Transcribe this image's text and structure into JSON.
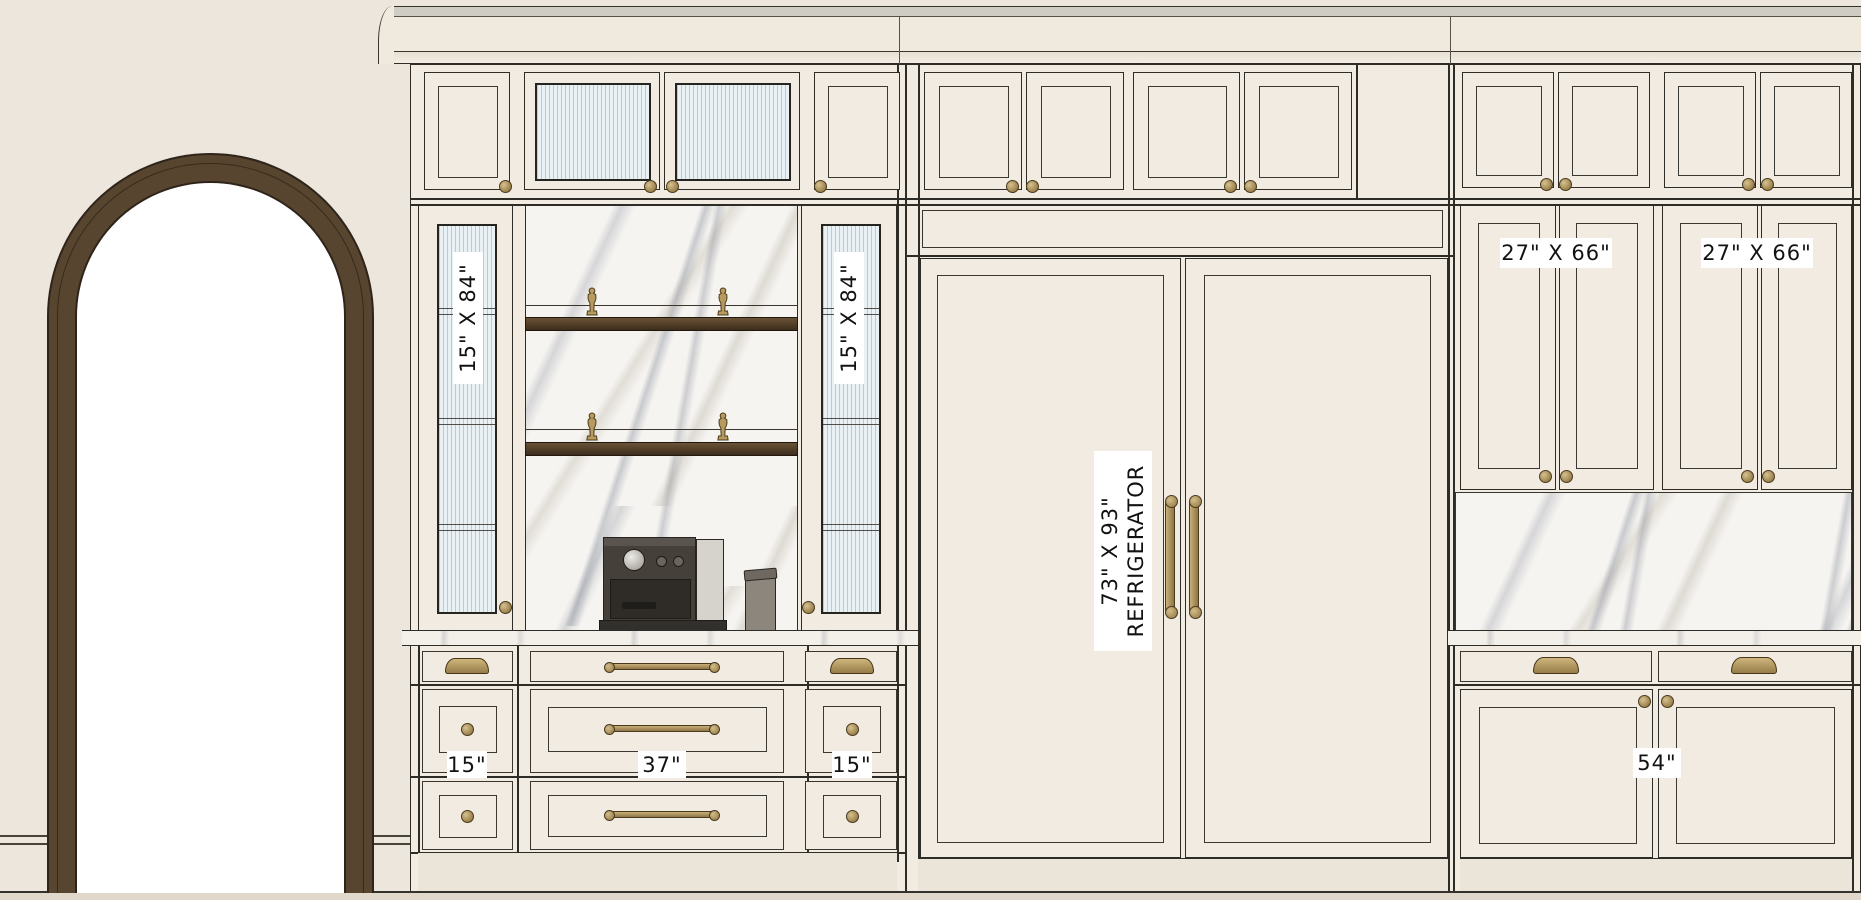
{
  "drawing": {
    "type": "kitchen-cabinetry-elevation",
    "labels": {
      "left_glass_left": "15\" X 84\"",
      "left_glass_right": "15\" X 84\"",
      "base_left": "15\"",
      "base_center": "37\"",
      "base_right": "15\"",
      "fridge_size": "73\" X 93\"",
      "fridge_name": "REFRIGERATOR",
      "right_upper_left": "27\" X 66\"",
      "right_upper_right": "27\" X 66\"",
      "right_base": "54\""
    },
    "colors": {
      "wall": "#ece6dc",
      "cabinet_face": "#f1ebe2",
      "outline": "#2e2c27",
      "brass": "#b2945c",
      "wood_shelf": "#553f2a",
      "arch_frame": "#57452f",
      "marble": "#f6f4f1",
      "fluted_glass": "#e3edf2"
    }
  }
}
